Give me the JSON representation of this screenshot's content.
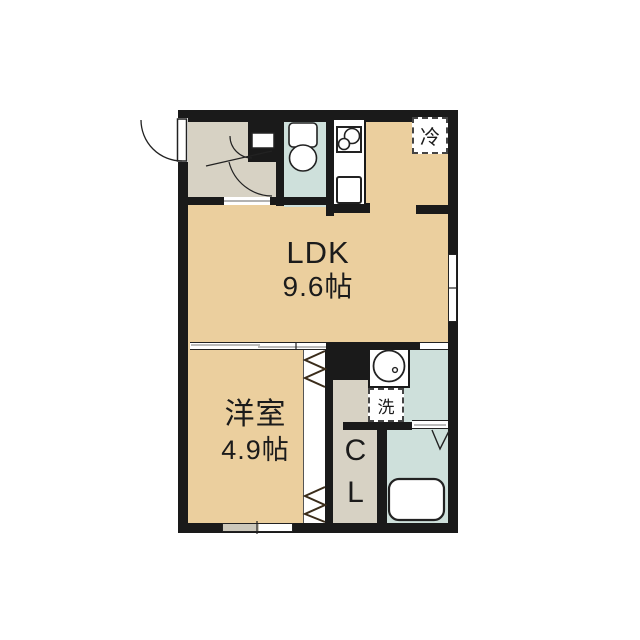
{
  "title": "apartment-floor-plan",
  "colors": {
    "wall": "#1a1a1a",
    "floor-tan": "#EBCF9E",
    "floor-gray": "#D7D2C4",
    "floor-blue": "#CEE0DB",
    "line": "#222222"
  },
  "rooms": {
    "ldk": {
      "name": "LDK",
      "size": "9.6帖"
    },
    "western_room": {
      "name": "洋室",
      "size": "4.9帖"
    },
    "closet": {
      "abbr_line1": "C",
      "abbr_line2": "L"
    },
    "fridge_space": {
      "label": "冷"
    },
    "washer_space": {
      "label": "洗"
    }
  },
  "icons": {
    "entrance_door": "quarter-circle swing arc, opens outward on left wall",
    "toilet": "tank + bowl symbol in toilet room",
    "toilet_door": "small quarter-circle swing arc",
    "ldk_door": "quarter-circle swing arc from hallway into hall",
    "kitchen_stove": "two-burner square symbol",
    "kitchen_sink": "square basin symbol",
    "washbasin": "round basin with tap dot",
    "bathtub": "rounded rectangle tub",
    "closet_folding_door": "zigzag symbol, two groups",
    "bathroom_folding_door": "V symbol",
    "sliding_door": "white band with offset track lines",
    "window": "double-line opening in wall"
  }
}
